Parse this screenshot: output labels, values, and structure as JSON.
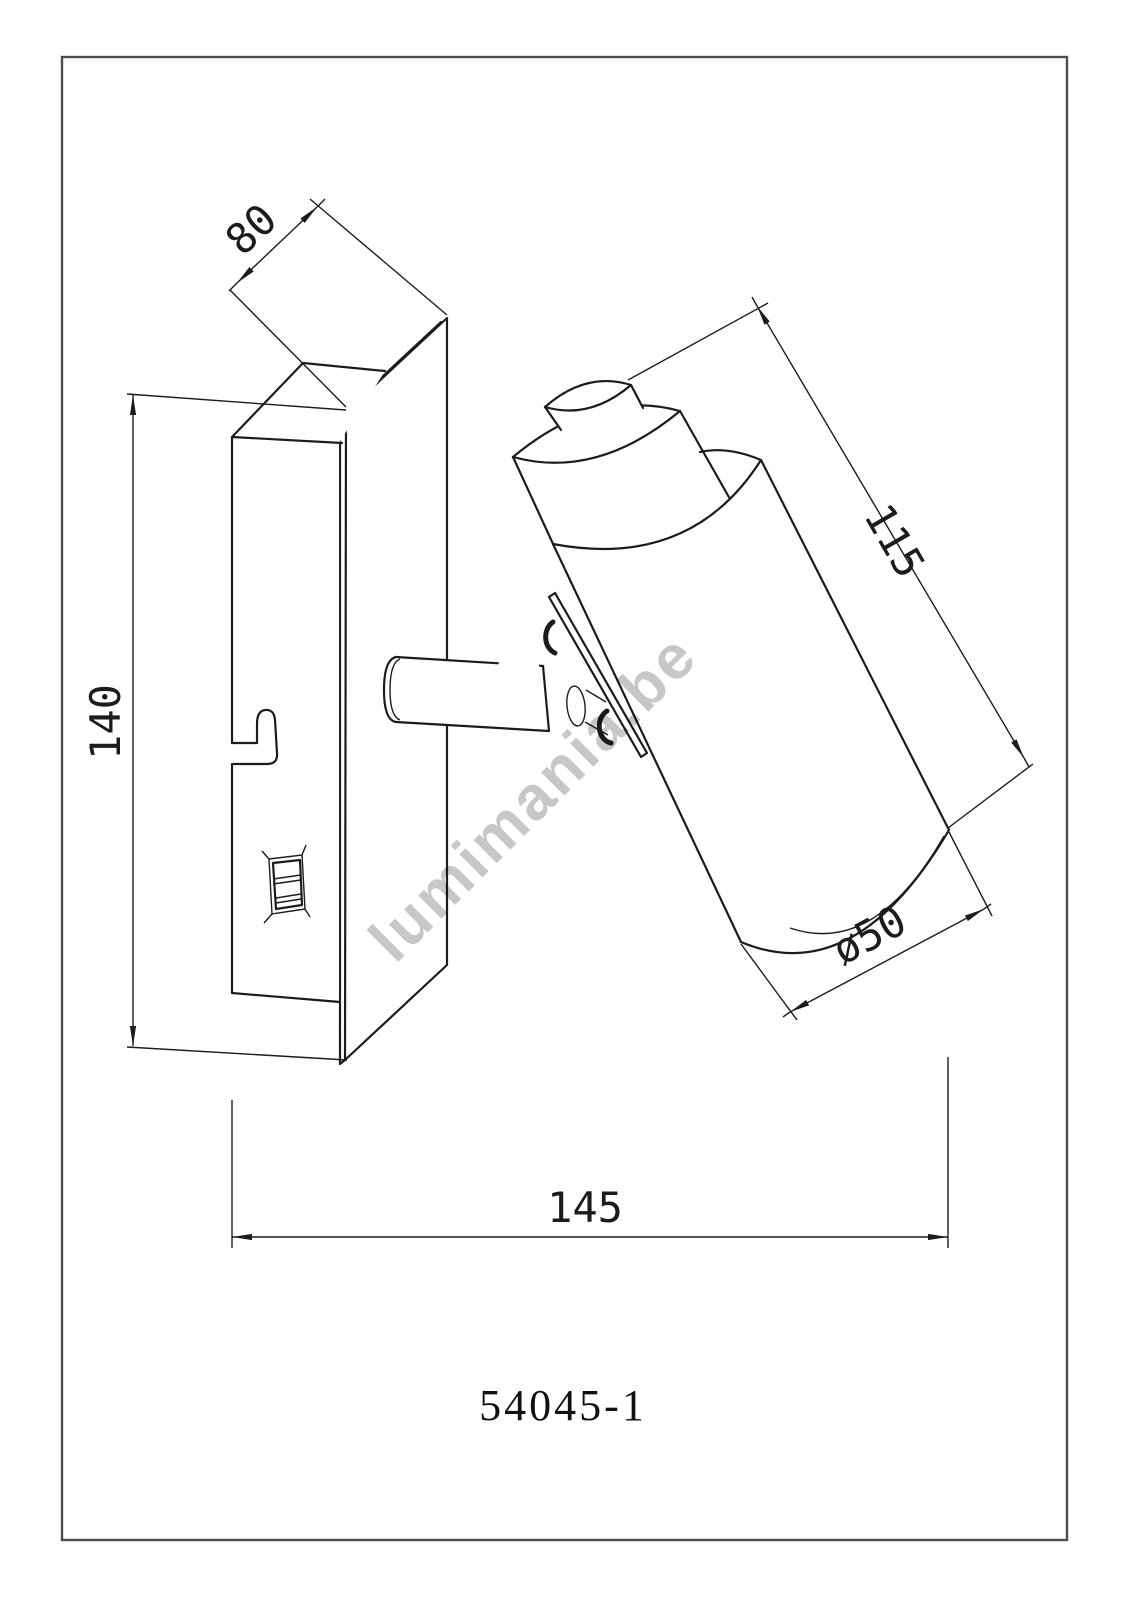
{
  "page": {
    "background": "#ffffff",
    "border_color": "#4d4d4d",
    "line_color": "#1c1c1c",
    "watermark_color": "#c7c7c7"
  },
  "drawing": {
    "type": "technical dimension drawing of wall spot light",
    "model_number": "54045-1",
    "watermark": "lumimania.be",
    "dimensions": {
      "plate_depth": {
        "label": "80",
        "value": 80
      },
      "plate_height": {
        "label": "140",
        "value": 140
      },
      "head_length": {
        "label": "115",
        "value": 115
      },
      "head_diameter": {
        "label": "ø50",
        "value": 50
      },
      "total_projection": {
        "label": "145",
        "value": 145
      }
    }
  }
}
